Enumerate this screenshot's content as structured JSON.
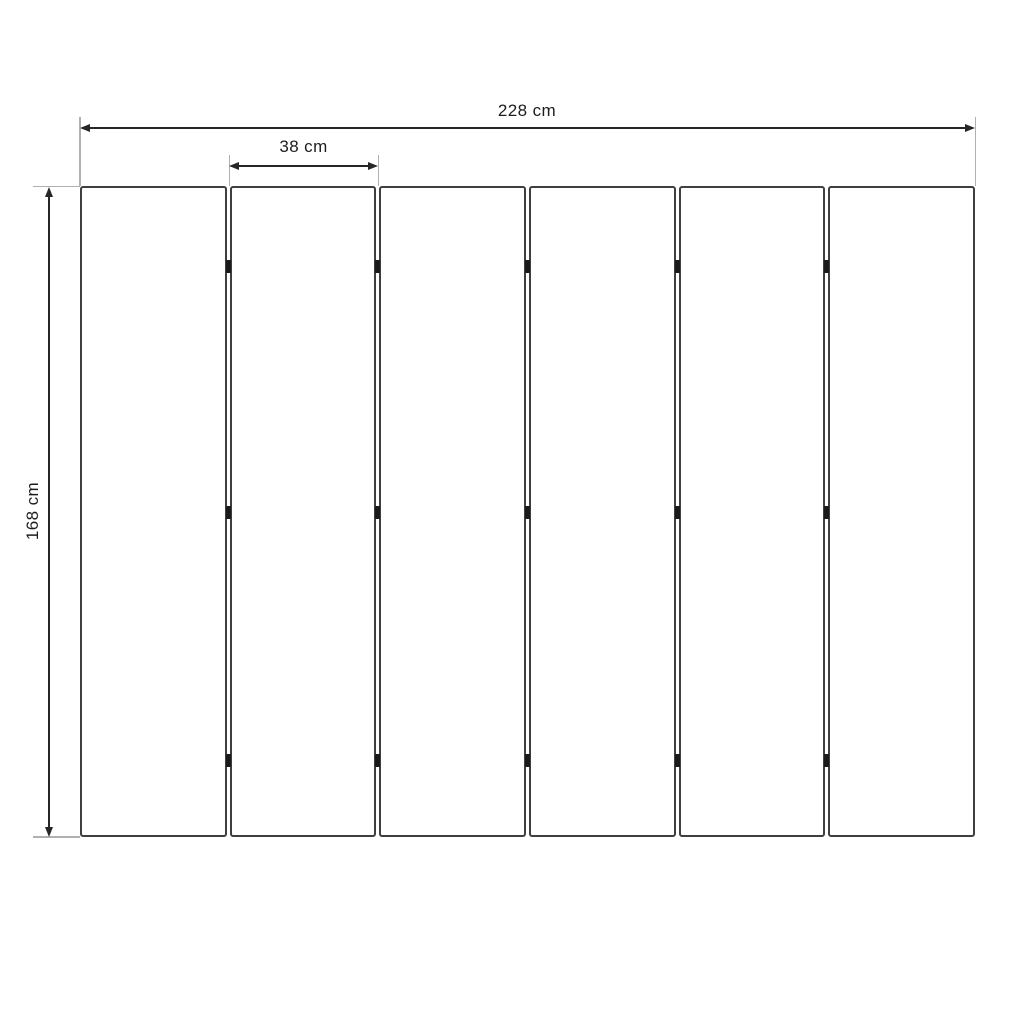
{
  "diagram": {
    "type": "dimension-drawing",
    "unit": "cm",
    "dimensions": {
      "total_width": {
        "label": "228 cm",
        "value": 228
      },
      "panel_width": {
        "label": "38 cm",
        "value": 38
      },
      "height": {
        "label": "168 cm",
        "value": 168
      }
    },
    "panels": {
      "count": 6,
      "hinge_gaps": 5,
      "hinge_rows_pct": [
        12.4,
        50.1,
        88.2
      ]
    },
    "colors": {
      "background": "#ffffff",
      "panel_border": "#3f3f3f",
      "dimension_line": "#262626",
      "extension_line": "#b0b0b0",
      "hinge": "#1a1a1a",
      "text": "#1d1d1d"
    }
  }
}
